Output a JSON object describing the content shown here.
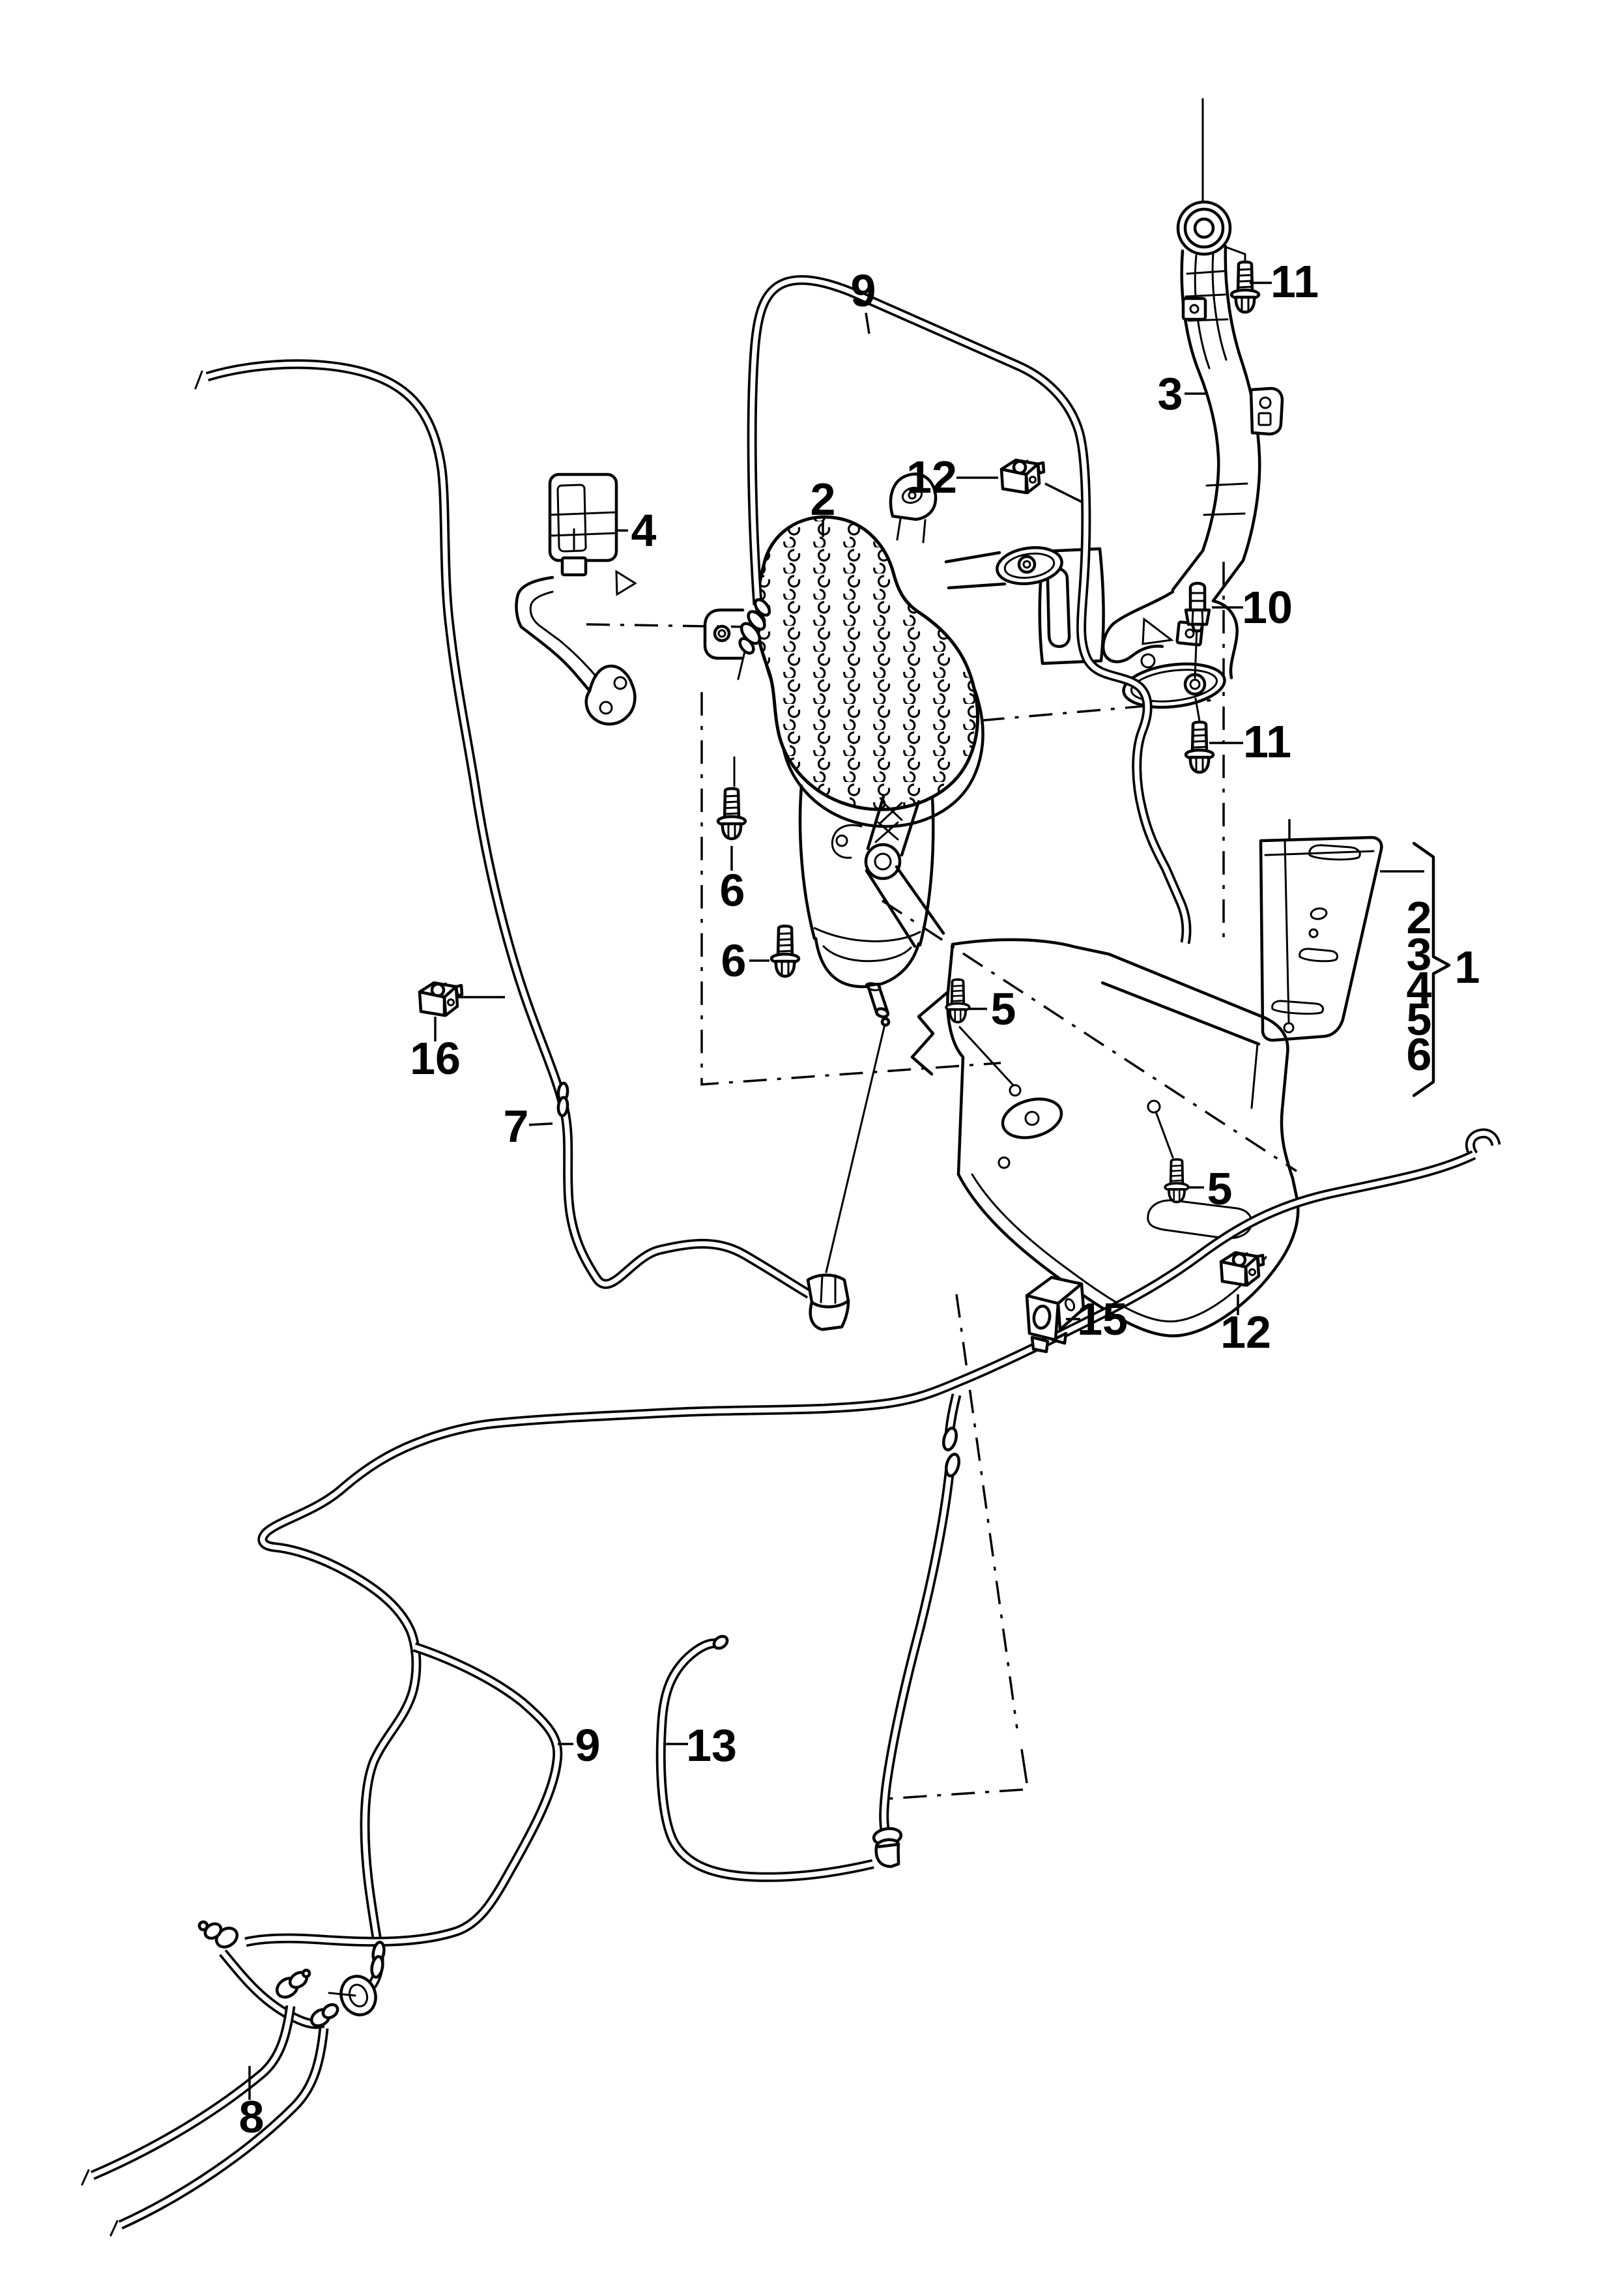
{
  "diagram": {
    "background": "#ffffff",
    "line_color": "#000000",
    "callouts": {
      "c9_top": "9",
      "c12_top": "12",
      "c3": "3",
      "c11_top": "11",
      "c4": "4",
      "c2": "2",
      "c10": "10",
      "c11_mid": "11",
      "c6_upper": "6",
      "c6_lower": "6",
      "c5_mid": "5",
      "c5_lower": "5",
      "c16": "16",
      "c7": "7",
      "c15": "15",
      "c12_lower": "12",
      "g2": "2",
      "g3": "3",
      "g4": "4",
      "g5": "5",
      "g6": "6",
      "c1": "1",
      "c9_bottom": "9",
      "c13": "13",
      "c8": "8"
    }
  }
}
